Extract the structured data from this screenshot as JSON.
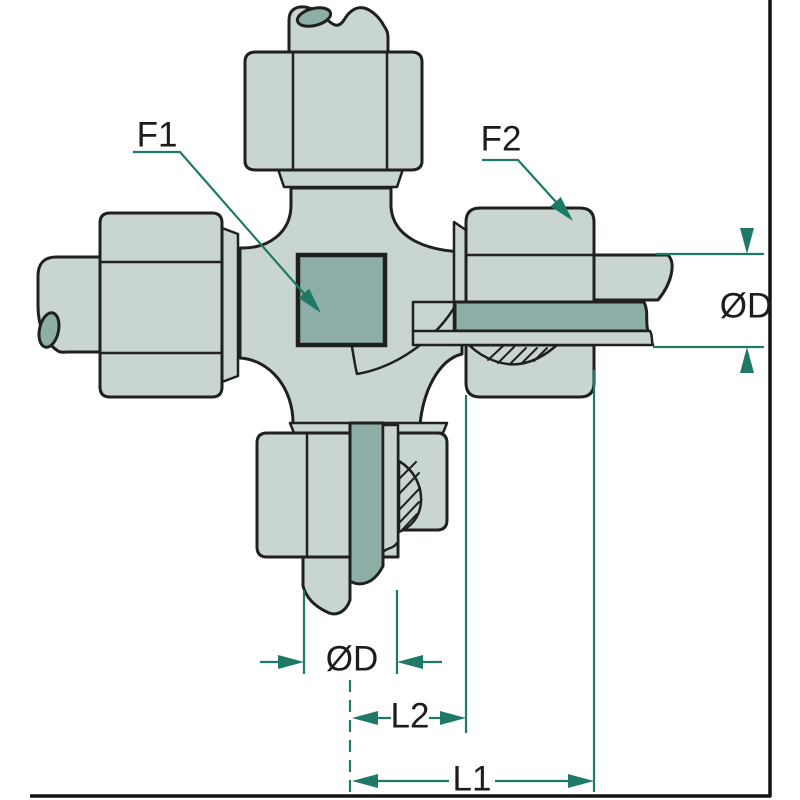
{
  "figure": {
    "callouts": {
      "f1": "F1",
      "f2": "F2"
    },
    "dimensions": {
      "od_right": "ØD",
      "od_bottom": "ØD",
      "l2": "L2",
      "l1": "L1"
    },
    "colors": {
      "background": "#ffffff",
      "body_fill": "#c9d5d1",
      "section_fill": "#8dafa7",
      "outline": "#20201e",
      "dimension_line": "#1e7a66",
      "label_text": "#1c1c1c",
      "frame_border": "#141414"
    }
  }
}
